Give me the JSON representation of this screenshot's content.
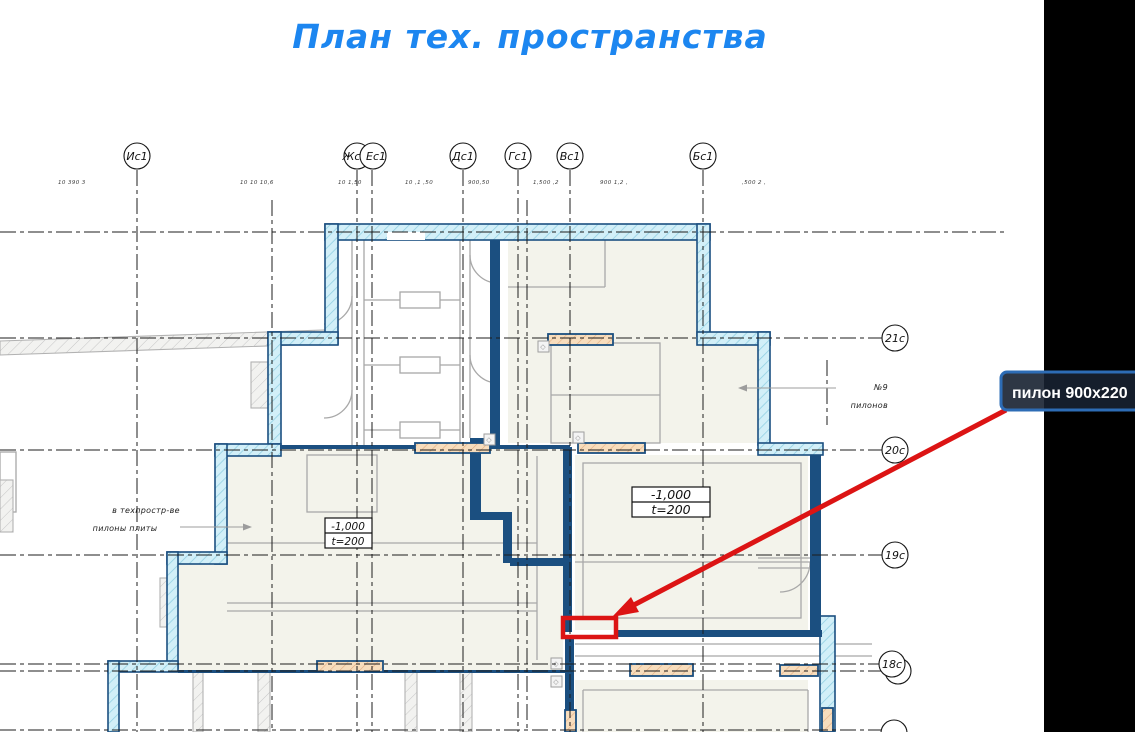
{
  "title": "План тех. пространства",
  "tooltip": {
    "label": "пилон 900x220"
  },
  "axes": {
    "top": [
      {
        "label": "Ис1"
      },
      {
        "label": "Жс1"
      },
      {
        "label": "Ес1"
      },
      {
        "label": "Дс1"
      },
      {
        "label": "Гс1"
      },
      {
        "label": "Вс1"
      },
      {
        "label": "Бс1"
      }
    ],
    "side": [
      {
        "label": "21с"
      },
      {
        "label": "20с"
      },
      {
        "label": "19с"
      },
      {
        "label": "18с"
      }
    ]
  },
  "dimensions": [
    "10 390 3",
    "10 10 10,6",
    "10 1,50",
    "10 ,1 ,50",
    "900,50",
    "1,500 ,2",
    "900 1,2 ,",
    ",500 2 ,"
  ],
  "level_boxes": [
    {
      "elevation": "-1,000",
      "thickness": "t=200"
    },
    {
      "elevation": "-1,000",
      "thickness": "t=200"
    }
  ],
  "annotations": {
    "left": {
      "line1": "в техпростр-ве",
      "line2": "пилоны плиты"
    },
    "right": {
      "line1": "№9",
      "line2": "пилонов"
    }
  },
  "colors": {
    "title_blue": "#1c86f0",
    "wall_blue": "#1b4f80",
    "wall_fill": "#d2eff8",
    "room_beige": "#f3f3eb",
    "pylon_orange": "#f7ddbd",
    "annotation_red": "#dc1414",
    "tooltip_border": "#2d6cb5",
    "tooltip_bg": "#172131",
    "panel_black": "#000000"
  }
}
